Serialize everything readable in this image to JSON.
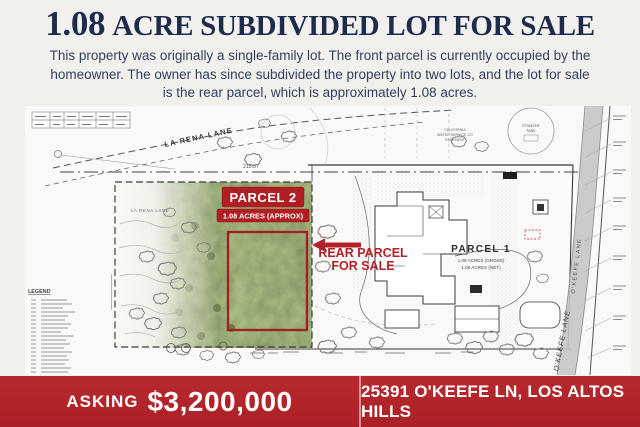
{
  "page": {
    "background": "#f2f0ed",
    "navy": "#1d2b4d",
    "accent_red": "#b2262c",
    "annotation_red": "#b2222a"
  },
  "header": {
    "title_lead": "1.08",
    "title_rest": "ACRE SUBDIVIDED LOT FOR SALE"
  },
  "intro": {
    "text": "This property was originally a single-family lot. The front parcel is currently occupied by the homeowner. The owner has since subdivided the property into two lots, and the lot for sale is the rear parcel, which is approximately 1.08 acres."
  },
  "map": {
    "street_top": "LA RENA LANE",
    "street_inner": "LA RENA LANE",
    "dim_top": "218.37",
    "parcel2": {
      "name": "PARCEL 2",
      "area": "1.08 ACRES (APPROX)"
    },
    "callout": {
      "line1": "REAR PARCEL",
      "line2": "FOR SALE"
    },
    "parcel1": {
      "name": "PARCEL 1",
      "area_gross": "1.08 ACRES (GROSS)",
      "area_net": "1.00 ACRES (NET)"
    },
    "street_right_upper": "O'KEEFE LANE",
    "street_right_lower": "O'KEEFE LANE",
    "tank": {
      "line1": "ETWATER",
      "line2": "TANK"
    },
    "easement": {
      "line1": "CALIFORNIA",
      "line2": "WATER SERVICE CO",
      "line3": "EASEMENT"
    },
    "legend_title": "LEGEND"
  },
  "banner": {
    "asking_label": "ASKING",
    "price": "$3,200,000",
    "address": "25391 O'KEEFE LN, LOS ALTOS HILLS"
  }
}
